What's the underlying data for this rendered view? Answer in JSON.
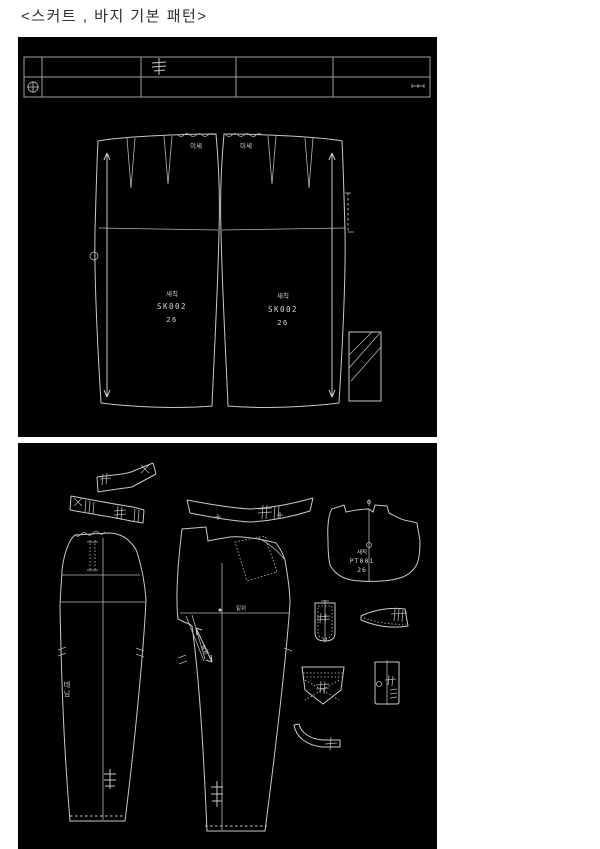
{
  "page": {
    "title": "<스커트 , 바지 기본 패턴>"
  },
  "skirt": {
    "ease_left": "이세",
    "ease_right": "미세",
    "piece_left": {
      "fabric": "새칙",
      "code": "SK002",
      "size": "26"
    },
    "piece_right": {
      "fabric": "새칙",
      "code": "SK002",
      "size": "26"
    }
  },
  "pants": {
    "yoke": {
      "fabric": "새칙",
      "code": "PT001",
      "size": "26"
    },
    "back_fabric_label": "데님",
    "crotch_label": "밑위",
    "stretch_label": "늘림"
  }
}
